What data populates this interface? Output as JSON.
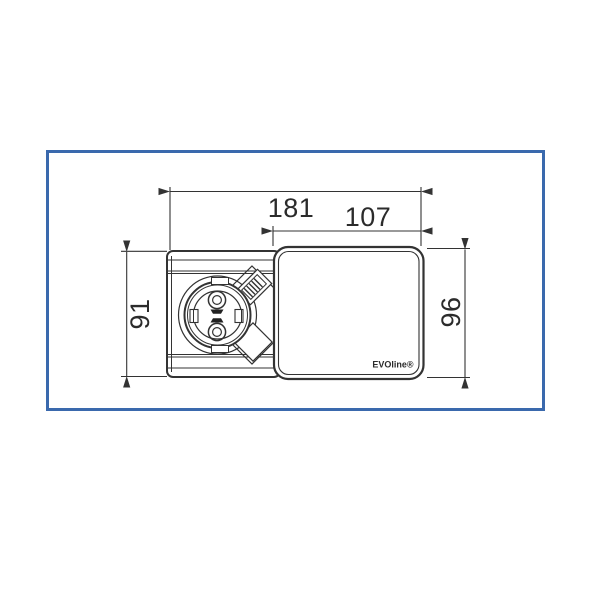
{
  "frame": {
    "border_color": "#3a69ad",
    "background": "#ffffff"
  },
  "drawing": {
    "line_color": "#333333",
    "dimensions": {
      "total_width": "181",
      "cover_width": "107",
      "body_height": "91",
      "cover_height": "96"
    },
    "cover": {
      "logo": "EVOline®"
    }
  }
}
